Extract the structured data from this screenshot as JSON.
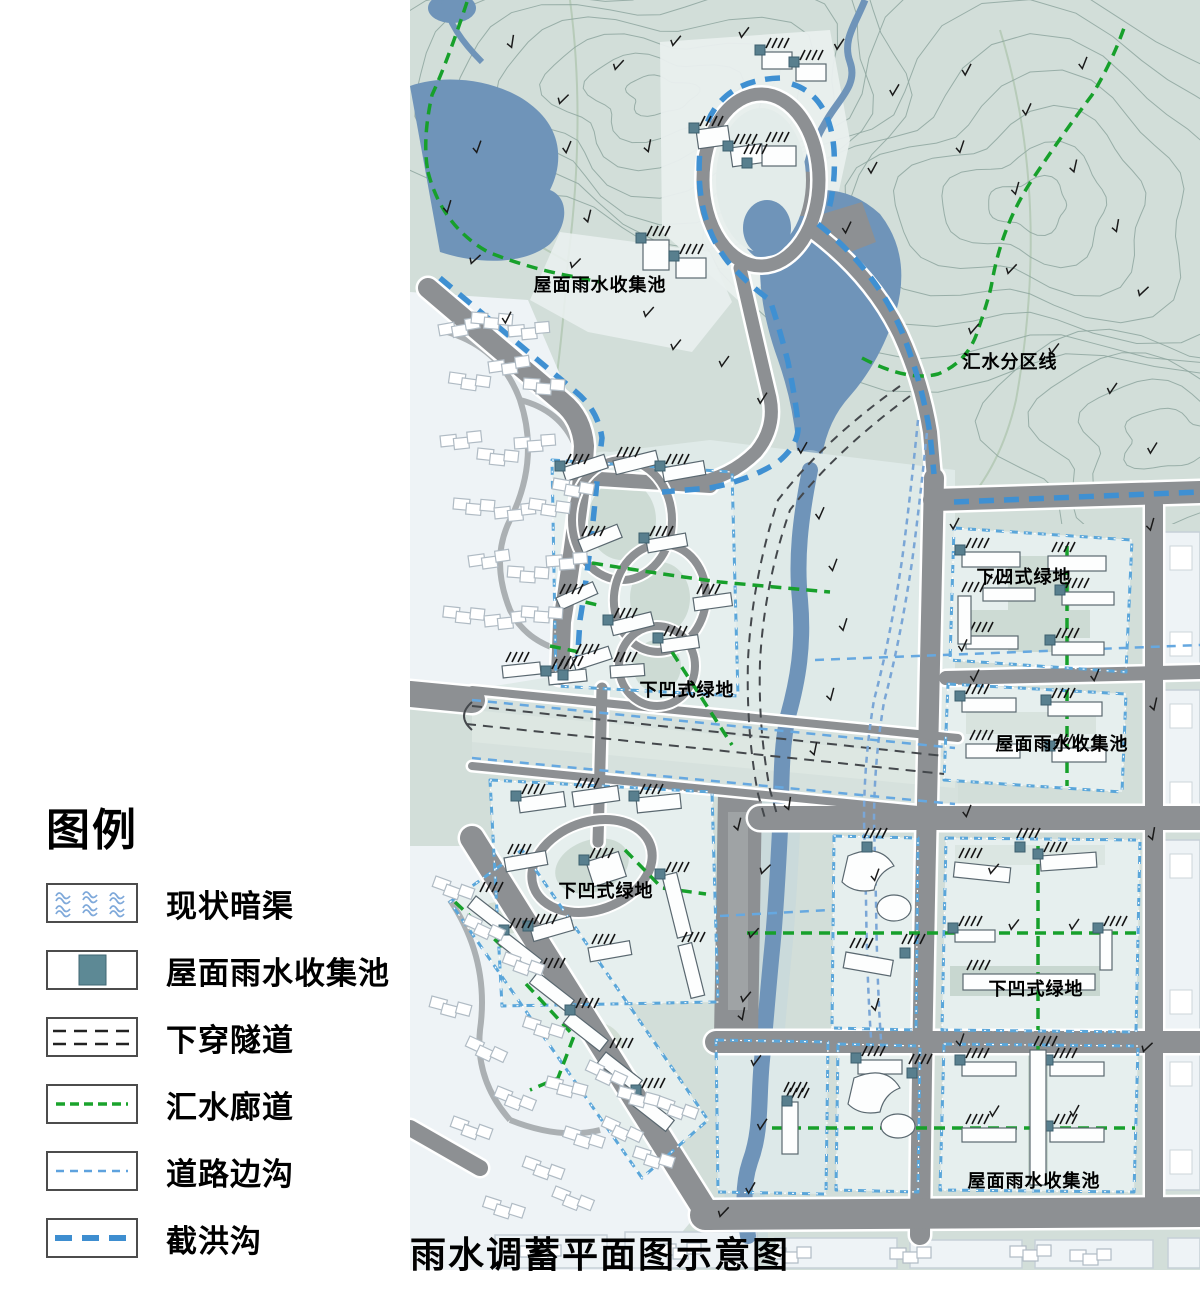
{
  "legend": {
    "title": "图例",
    "items": [
      {
        "id": "existing-culvert",
        "label": "现状暗渠"
      },
      {
        "id": "roof-rainwater-pool",
        "label": "屋面雨水收集池"
      },
      {
        "id": "underpass-tunnel",
        "label": "下穿隧道"
      },
      {
        "id": "catchment-corridor",
        "label": "汇水廊道"
      },
      {
        "id": "road-side-ditch",
        "label": "道路边沟"
      },
      {
        "id": "flood-interception-ditch",
        "label": "截洪沟"
      }
    ]
  },
  "map": {
    "title": "雨水调蓄平面图示意图",
    "labels": [
      {
        "id": "roof-pool-top",
        "text": "屋面雨水收集池",
        "x": 190,
        "y": 284
      },
      {
        "id": "catchment-division",
        "text": "汇水分区线",
        "x": 600,
        "y": 361
      },
      {
        "id": "sunken-green-park",
        "text": "下凹式绿地",
        "x": 277,
        "y": 689
      },
      {
        "id": "sunken-green-ne",
        "text": "下凹式绿地",
        "x": 614,
        "y": 576
      },
      {
        "id": "roof-pool-ne",
        "text": "屋面雨水收集池",
        "x": 652,
        "y": 743
      },
      {
        "id": "sunken-green-west",
        "text": "下凹式绿地",
        "x": 196,
        "y": 890
      },
      {
        "id": "sunken-green-east",
        "text": "下凹式绿地",
        "x": 626,
        "y": 988
      },
      {
        "id": "roof-pool-se",
        "text": "屋面雨水收集池",
        "x": 624,
        "y": 1180
      }
    ]
  },
  "colors": {
    "terrain": "#d2ded9",
    "water": "#6f94b9",
    "road": "#8d9093",
    "new_block": "#e6efee",
    "existing_block": "#eef3f6",
    "roof_pool_teal": "#587f8e",
    "interception_blue": "#3f90d2",
    "road_ditch_blue": "#66a8e0",
    "culvert_blue": "#7aa6d6",
    "corridor_green": "#17a02b",
    "tunnel_dark": "#44484c"
  }
}
